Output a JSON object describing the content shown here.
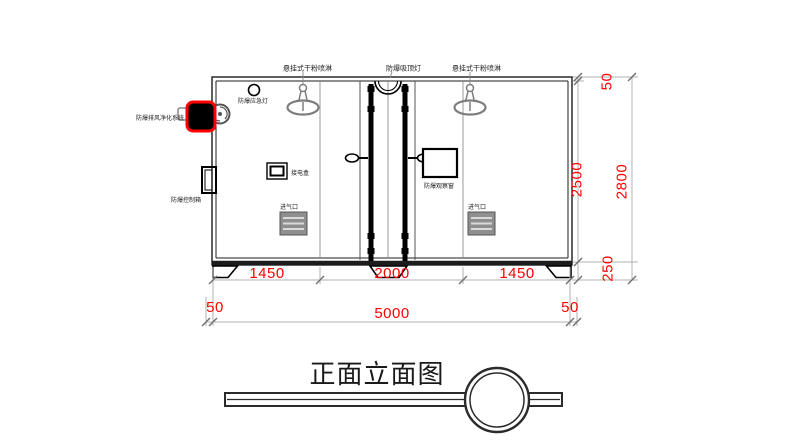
{
  "drawing": {
    "title": "正面立面图",
    "labels": {
      "sprinkler_left": "悬挂式干粉喷淋",
      "ceiling_light": "防爆吸顶灯",
      "sprinkler_right": "悬挂式干粉喷淋",
      "emergency_light": "防爆应急灯",
      "exhaust_system": "防爆排风净化系统",
      "control_box": "防爆控制箱",
      "junction_box": "接电盒",
      "observation_window": "防爆观察窗",
      "air_inlet_left": "进气口",
      "air_inlet_right": "进气口"
    },
    "dims": {
      "seg_left": "1450",
      "seg_mid": "2000",
      "seg_right": "1450",
      "bottom_left_offset": "50",
      "total_width": "5000",
      "bottom_right_offset": "50",
      "right_top_offset": "50",
      "body_height": "2500",
      "base_height": "250",
      "total_height": "2800"
    },
    "colors": {
      "dimension_text": "#ff0000",
      "highlight_border": "#ff0000",
      "line": "#1c1c1c"
    }
  }
}
